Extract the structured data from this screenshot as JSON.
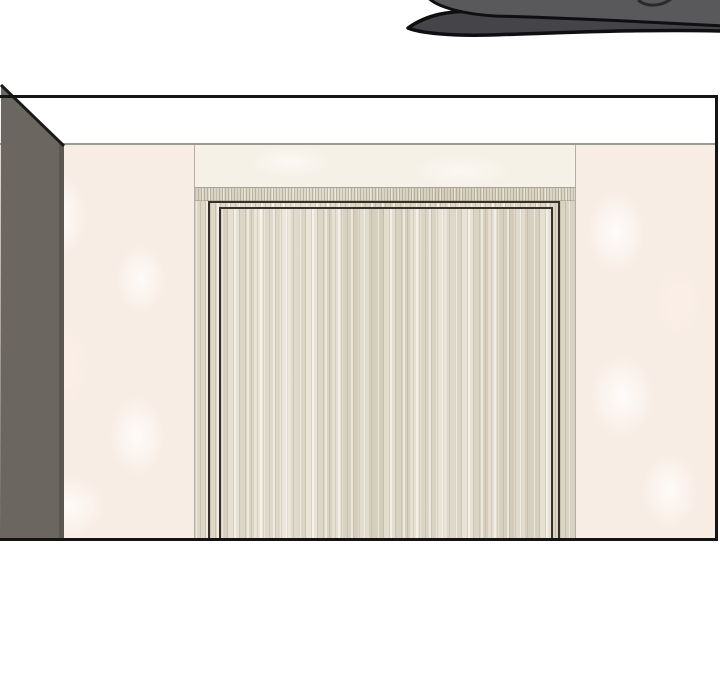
{
  "page": {
    "kind": "comic-panel-page",
    "text_content": "none",
    "description": "Borderless white comic page. A cut-off dark gray object from the previous panel shows at the top right. The main rectangular panel depicts a room corner: a dark gray side wall in perspective on the left, white ceiling, pinkish-cream blotchy walls, and a light wood-grain door with a dark-outlined casing centered, cropped by the panel's bottom border."
  },
  "scene": {
    "previous_panel_art": "bottom edge of a dark gray rounded object (two overlapping gray layers with black outlines), cropped by the top of the page",
    "main_panel": {
      "left_side_wall": "dark warm-gray wall receding in perspective, diagonal black edge meeting the ceiling",
      "ceiling": "flat white strip separated from walls by a thin gray line",
      "walls": "pale pink-cream wallpaper with soft white blotches",
      "door": "light beige wood-grain door and jamb, double dark casing outline, no handle visible, cut off at the bottom by the panel frame"
    }
  },
  "colors": {
    "page_bg": "#ffffff",
    "panel_border": "#141414",
    "ceiling_white": "#ffffff",
    "ceiling_line": "#9c9892",
    "gray_wall": "#6c6660",
    "gray_wall_shade": "#5d5751",
    "gray_wall_edge": "#1a1a18",
    "wall_cream": "#f8ede5",
    "wall_center": "#f6f1e7",
    "wood_base": "#ddd6c6",
    "door_slab": "#e2dbcb",
    "casing_line": "#35302a",
    "top_shape": "#59595c",
    "under_shape": "#454549",
    "art_outline": "#0f0f11"
  }
}
